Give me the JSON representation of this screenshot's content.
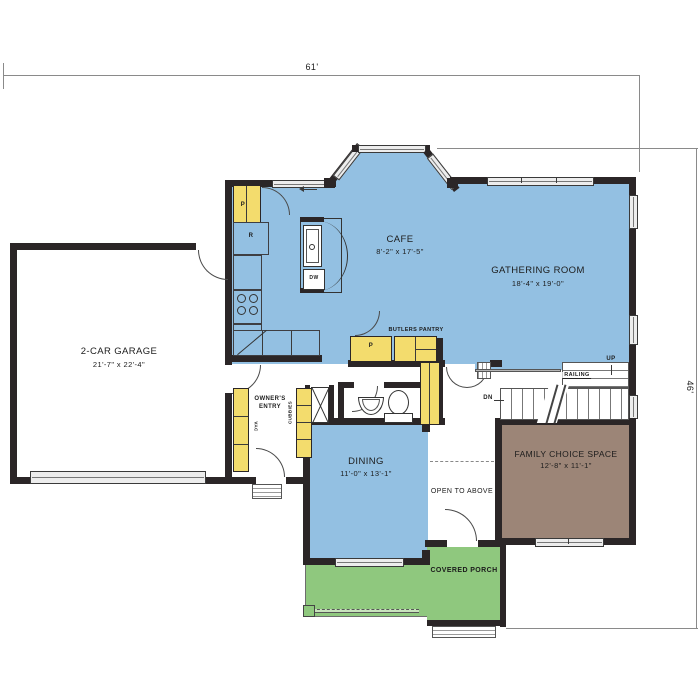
{
  "labels": {
    "dim_top": "61'",
    "dim_right": "46'",
    "garage_name": "2-CAR GARAGE",
    "garage_dims": "21'-7\" x 22'-4\"",
    "cafe_name": "CAFE",
    "cafe_dims": "8'-2\" x 17'-5\"",
    "gathering_name": "GATHERING ROOM",
    "gathering_dims": "18'-4\" x 19'-0\"",
    "dining_name": "DINING",
    "dining_dims": "11'-0\" x 13'-1\"",
    "family_name": "FAMILY CHOICE SPACE",
    "family_dims": "12'-8\" x 11'-1\"",
    "owners_entry": "OWNER'S ENTRY",
    "butlers_pantry": "BUTLERS PANTRY",
    "open_above": "OPEN TO ABOVE",
    "covered_porch": "COVERED PORCH",
    "railing": "RAILING",
    "up": "UP",
    "dn": "DN",
    "cubbies": "CUBBIES",
    "vac": "VAC",
    "pantry_kitchen": "P",
    "pantry_butlers": "P",
    "refrigerator": "R",
    "dishwasher": "DW"
  },
  "colors": {
    "room_blue": "#93c0e2",
    "cabinet_yellow": "#f3dc6d",
    "family_brown": "#9c8577",
    "porch_green": "#8fc87e",
    "wall_dark": "#2b2627",
    "window_gray": "#ededed"
  }
}
